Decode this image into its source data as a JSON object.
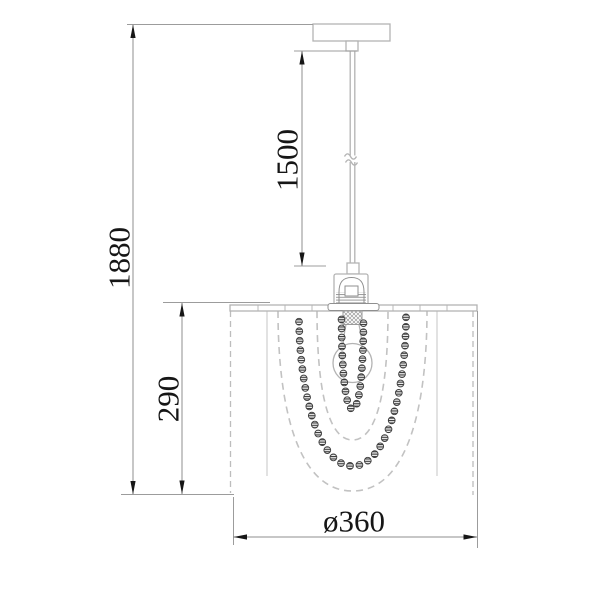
{
  "object": "pendant-ceiling-lamp-technical-drawing",
  "dimensions": {
    "overall_height": "1880",
    "suspension_length": "1500",
    "shade_height": "290",
    "shade_diameter": "ø360"
  },
  "colors": {
    "background": "#ffffff",
    "dimension_line": "#8f8f8f",
    "extension_line": "#9c9c9c",
    "arrow_and_text": "#161616",
    "object_line": "#b3b3b3",
    "bead_outline": "#3c3c3c"
  }
}
